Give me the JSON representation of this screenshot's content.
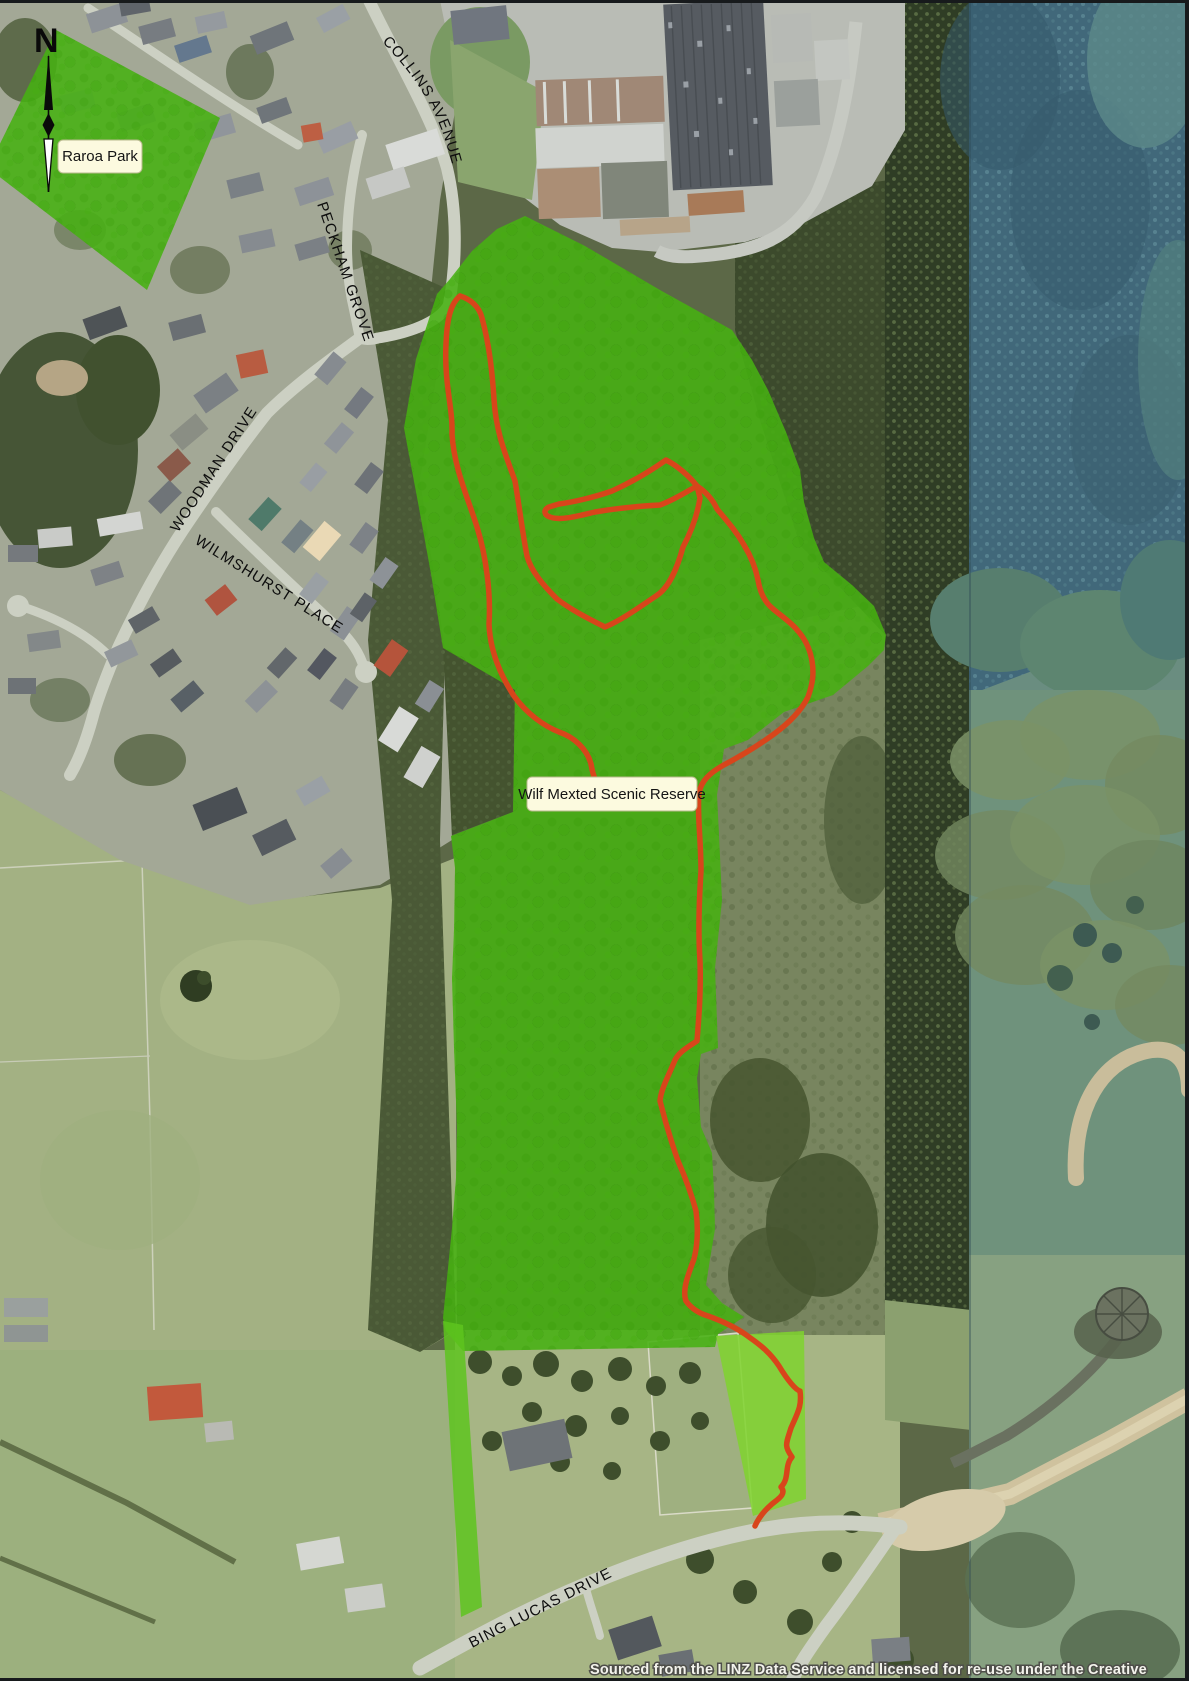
{
  "map": {
    "north": "N",
    "labels": {
      "park": "Raroa Park",
      "reserve": "Wilf Mexted Scenic Reserve"
    },
    "streets": {
      "collins": "COLLINS AVENUE",
      "peckham": "PECKHAM GROVE",
      "woodman": "WOODMAN DRIVE",
      "wilmshurst": "WILMSHURST PLACE",
      "bing_lucas": "BING LUCAS DRIVE"
    },
    "attribution": "Sourced from the LINZ Data Service and licensed for re-use under the Creative",
    "colors": {
      "reserve_fill": "#47b112",
      "parcel_fill": "#7fd42e",
      "strip_fill": "#5ec41e",
      "track": "#d8451b",
      "label_bg": "#fcfadf"
    }
  }
}
